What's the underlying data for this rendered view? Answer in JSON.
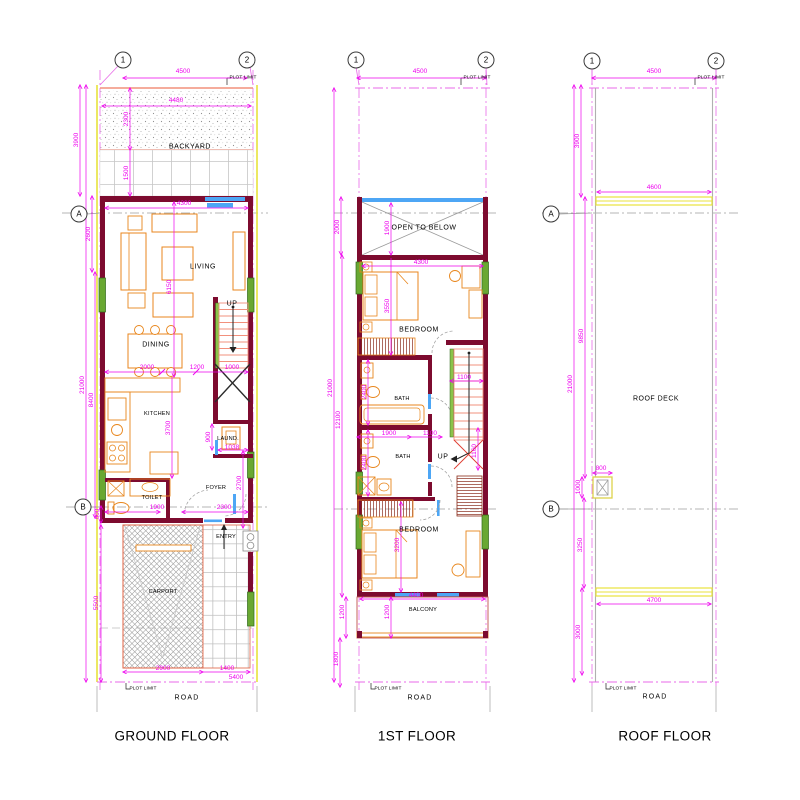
{
  "colors": {
    "wall": "#7d0b2f",
    "window_green": "#69a832",
    "door_blue": "#4da6f5",
    "furniture_orange": "#e8861c",
    "dimension_magenta": "#ee00ee",
    "plot_limit_yellow": "#e8e23c",
    "stair_salmon": "#f2907c",
    "grid_gray": "#b5b5b5"
  },
  "ground": {
    "title": "GROUND FLOOR",
    "bubbles": {
      "c1": "1",
      "c2": "2",
      "ra": "A",
      "rb": "B"
    },
    "rooms": {
      "backyard": "BACKYARD",
      "living": "LIVING",
      "dining": "DINING",
      "kitchen": "KITCHEN",
      "laundry": "LAUND.",
      "toilet": "TOILET",
      "foyer": "FOYER",
      "entry": "ENTRY",
      "carport": "CARPORT",
      "up": "UP"
    },
    "dims": {
      "d4500": "4500",
      "d4480": "4480",
      "d2300": "2300",
      "d3900": "3900",
      "d1500": "1500",
      "d4300": "4300",
      "d2600": "2600",
      "d6150": "6150",
      "d2000": "2000",
      "d1200": "1200",
      "d1000": "1000",
      "d21000": "21000",
      "d8400": "8400",
      "d3700": "3700",
      "d900": "900",
      "d1038": "1038",
      "d2700": "2700",
      "d1900": "1900",
      "d600": "600",
      "d2300b": "2300",
      "d5500": "5500",
      "d2900": "2900",
      "d1400": "1400",
      "d5400": "5400"
    },
    "notes": {
      "plot_top": "PLOT LIMIT",
      "plot_bottom": "PLOT LIMIT",
      "road": "ROAD"
    }
  },
  "first": {
    "title": "1ST FLOOR",
    "bubbles": {
      "c1": "1",
      "c2": "2"
    },
    "rooms": {
      "open": "OPEN TO BELOW",
      "bedroom1": "BEDROOM",
      "bath1": "BATH",
      "bath2": "BATH",
      "bedroom2": "BEDROOM",
      "balcony": "BALCONY",
      "up": "UP"
    },
    "dims": {
      "d4500": "4500",
      "d2000": "2000",
      "d1900a": "1900",
      "d4300": "4300",
      "d3550": "3550",
      "d21000": "21000",
      "d12100": "12100",
      "d2400a": "2400",
      "d1900b": "1900",
      "d1100a": "1100",
      "d1100b": "1100",
      "d1160": "1160",
      "d2400b": "2400",
      "d3200": "3200",
      "d4400": "4400",
      "d1200a": "1200",
      "d1200b": "1200",
      "d1800": "1800"
    },
    "notes": {
      "plot_top": "PLOT LIMIT",
      "plot_bottom": "PLOT LIMIT",
      "road": "ROAD"
    }
  },
  "roof": {
    "title": "ROOF FLOOR",
    "bubbles": {
      "c1": "1",
      "c2": "2",
      "ra": "A",
      "rb": "B"
    },
    "rooms": {
      "deck": "ROOF DECK"
    },
    "dims": {
      "d4500": "4500",
      "d3900": "3900",
      "d4600": "4600",
      "d9850": "9850",
      "d21000": "21000",
      "d800": "800",
      "d1000": "1000",
      "d3250": "3250",
      "d4700": "4700",
      "d3000": "3000"
    },
    "notes": {
      "plot_top": "PLOT LIMIT",
      "plot_bottom": "PLOT LIMIT",
      "road": "ROAD"
    }
  }
}
